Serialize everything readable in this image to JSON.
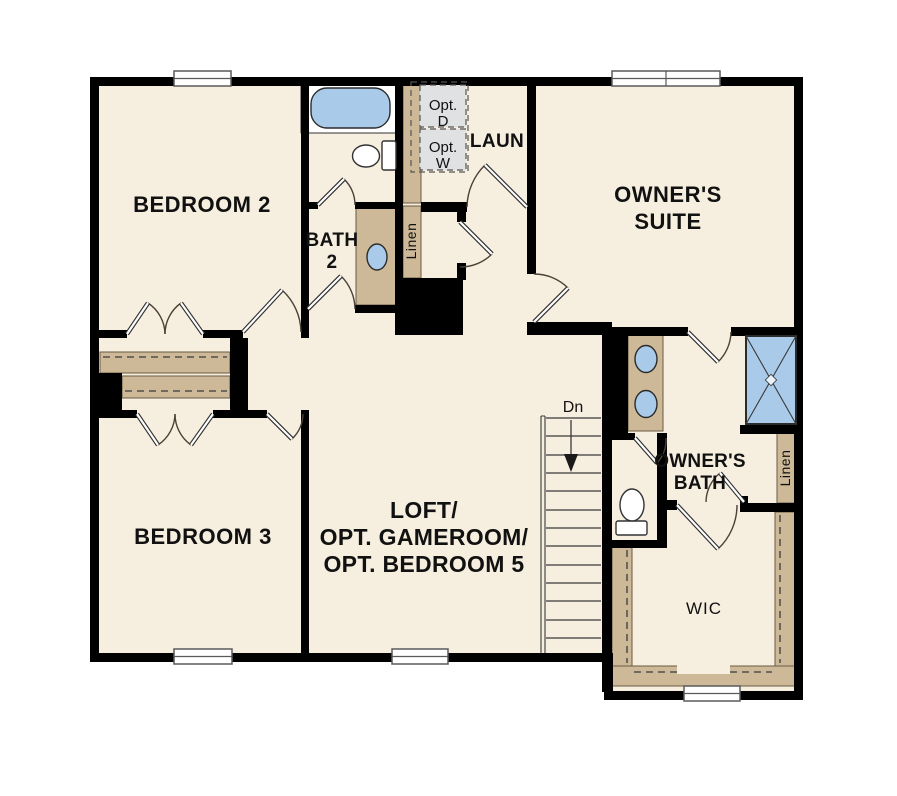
{
  "colors": {
    "floor": "#f6eedf",
    "wall": "#000000",
    "cabinet": "#cdb998",
    "fixture_blue": "#a9cbe9",
    "appliance_gray": "#e0e1e3",
    "line": "#3a3a3a"
  },
  "rooms": {
    "bedroom2": {
      "label": "BEDROOM 2"
    },
    "bath2": {
      "line1": "BATH",
      "line2": "2"
    },
    "laundry": {
      "label": "LAUN",
      "opt_dryer_line1": "Opt.",
      "opt_dryer_line2": "D",
      "opt_washer_line1": "Opt.",
      "opt_washer_line2": "W"
    },
    "linen_hall": {
      "label": "Linen"
    },
    "owners_suite": {
      "line1": "OWNER'S",
      "line2": "SUITE"
    },
    "bedroom3": {
      "label": "BEDROOM 3"
    },
    "loft": {
      "line1": "LOFT/",
      "line2": "OPT. GAMEROOM/",
      "line3": "OPT. BEDROOM 5"
    },
    "stairs": {
      "label": "Dn"
    },
    "owners_bath": {
      "line1": "OWNER'S",
      "line2": "BATH"
    },
    "linen_owners": {
      "label": "Linen"
    },
    "wic": {
      "label": "WIC"
    }
  }
}
